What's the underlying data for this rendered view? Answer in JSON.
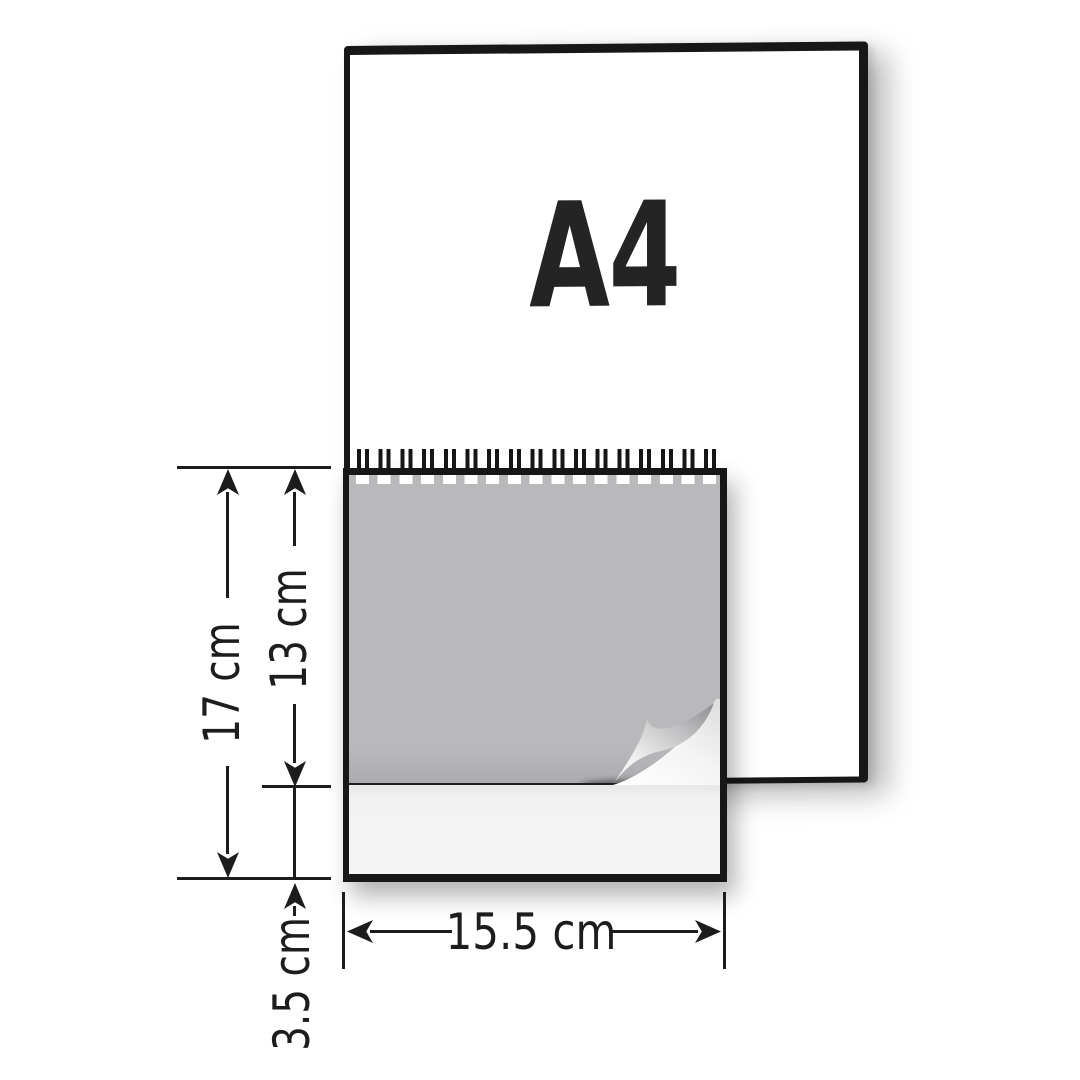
{
  "diagram": {
    "a4": {
      "label": "A4"
    },
    "dims": {
      "total_height": "17 cm",
      "front_page_height": "13 cm",
      "base_height": "3.5 cm",
      "width": "15.5 cm"
    },
    "spiral": {
      "loop_count": 17
    },
    "colors": {
      "outline": "#171717",
      "dimension_ink": "#1c1c1c",
      "front_page_gray": "#b9b9bc",
      "base_page_light": "#f3f3f3",
      "background": "#ffffff"
    }
  }
}
